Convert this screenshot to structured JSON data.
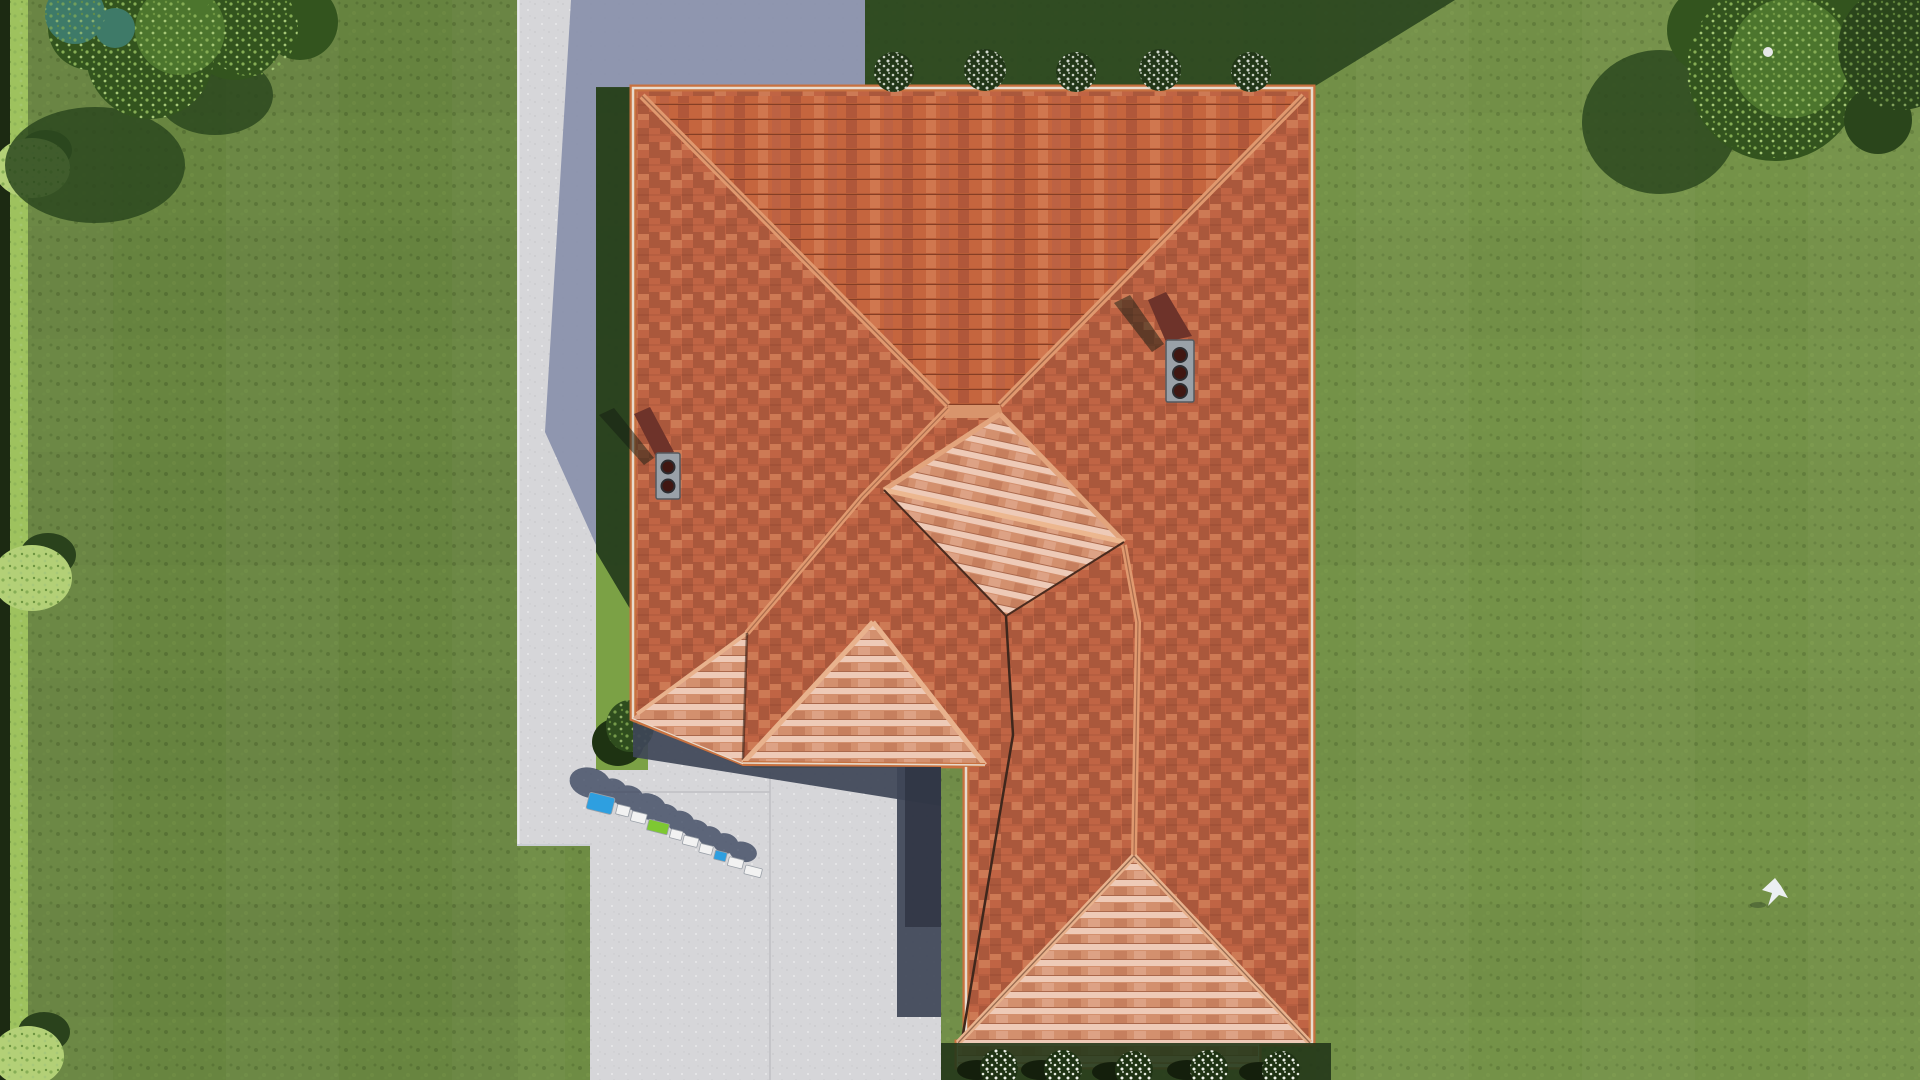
{
  "scene": {
    "type": "aerial-3d-render",
    "subject": "top-down view of a house with terracotta hip roof, lawn, driveway and trees",
    "watermark_logo": {
      "style": "3d-extruded-blocks",
      "block_count": 10
    },
    "bird_present": true
  },
  "colors": {
    "grass": "#6e8c44",
    "grass_bright": "#7ba145",
    "grass_shadow_strip": "#2b4620",
    "grass_shadow_dark": "#273f1d",
    "hedge_dark": "#1c2a12",
    "hedge_light": "#9ec25e",
    "hedge_bush": "#b3d077",
    "driveway": "#d6d6d9",
    "concrete_shadow": "#8b93ad",
    "wall_shadow": "#3e4557",
    "roof_base": "#c06444",
    "roof_dark_tile": "#aa583c",
    "roof_light_plane": "#d3906e",
    "ridge_cap": "#e0996f",
    "ridge_cap_light": "#e8b28d",
    "valley": "#3f271c",
    "fascia": "#e8dbcd",
    "eave_band": "#c8713f",
    "chimney_cap": "#9aa1a8",
    "chimney_body": "#6e332a",
    "chimney_vent": "#401712",
    "tree_dark": "#33541e",
    "tree_mid": "#4c752d",
    "tree_light": "#86ad55",
    "tree_teal": "#3e7a68",
    "tree_shadow": "#2b481f",
    "flower_white": "#eef2ea",
    "bush_dark": "#233818",
    "logo_blue": "#2e9fe0",
    "logo_green": "#7ec832",
    "logo_white": "#f2f2f2",
    "logo_shadow": "#2e3a55",
    "bird_white": "#ecf0f2"
  },
  "inventory": {
    "chimneys": [
      {
        "vents": 2
      },
      {
        "vents": 3
      }
    ],
    "top_flower_bushes": 5,
    "bottom_flower_bushes": 5,
    "hedge_bushes": 3,
    "trees_top_left": 2,
    "trees_top_right": 2,
    "dormer_gables": 3
  }
}
